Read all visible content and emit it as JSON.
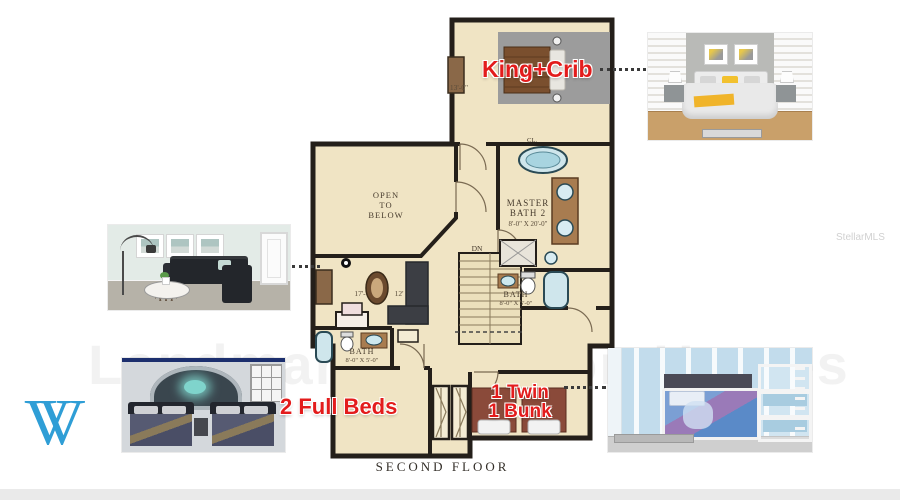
{
  "branding": {
    "logo_letter": "V",
    "logo_color": "#2f9ed6",
    "watermark_center": "Landmark Vacation Homes",
    "watermark_mls": "StellarMLS"
  },
  "plan": {
    "footer": "SECOND FLOOR",
    "colors": {
      "floor_fill": "#f0e4c4",
      "wall": "#241f1a",
      "fixture_blue": "#cfe6ec"
    },
    "labels": {
      "open1": "OPEN",
      "open2": "TO",
      "open3": "BELOW",
      "master1": "MASTER",
      "master2": "BATH 2",
      "master_dims": "8'-0\" X 20'-0\"",
      "bath_right": "BATH",
      "bath_right_dims": "8'-0\" X 5'-0\"",
      "bath_left": "BATH",
      "bath_left_dims": "8'-0\" X 5'-0\"",
      "loft_dims_a": "17'-",
      "loft_dims_b": "12'",
      "bedroom2_dims": "13'-0\"",
      "closet": "CL.",
      "down": "DN"
    }
  },
  "annotations": {
    "color": "#e31c1c",
    "king_crib": "King+Crib",
    "full_beds": "2 Full Beds",
    "twin": "1 Twin",
    "bunk": "1 Bunk"
  },
  "photos": {
    "king_bedroom": "king-bedroom-render",
    "living_room": "loft-living-room-render",
    "theater_room": "star-wars-two-full-beds-render",
    "kids_room": "frozen-twin-and-bunk-render"
  }
}
